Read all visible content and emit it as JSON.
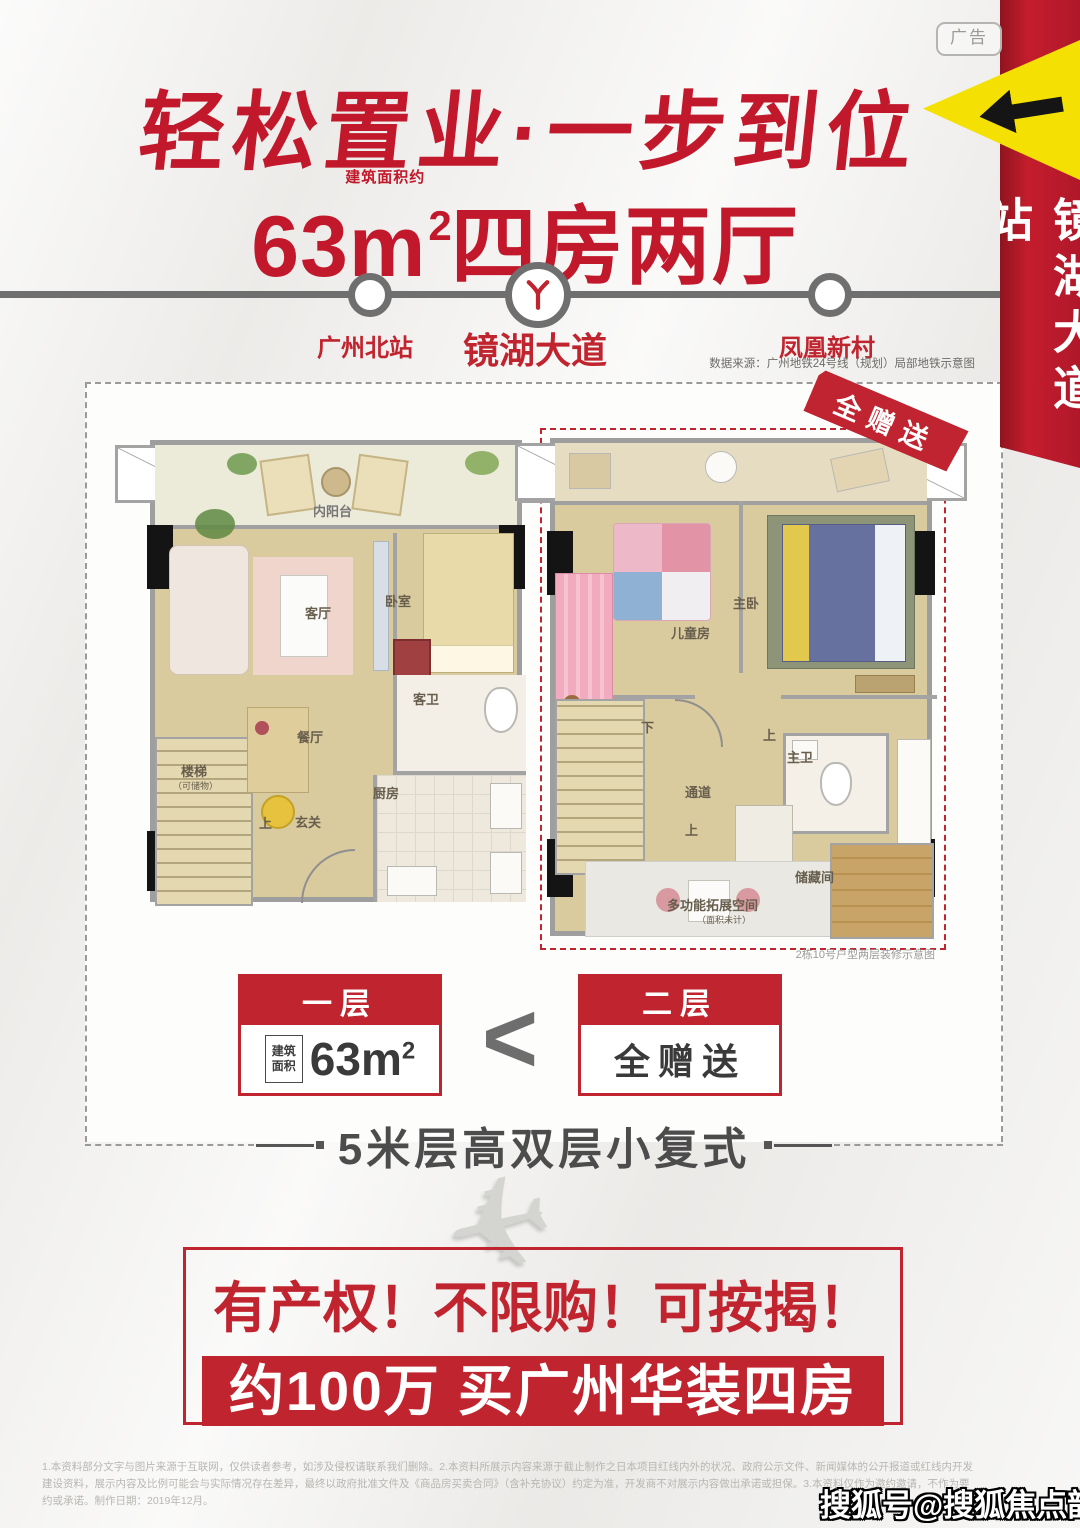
{
  "ad_badge": "广告",
  "side_banner": {
    "station": "镜湖大道站"
  },
  "title": "轻松置业·一步到位",
  "subtitle": {
    "area_note": "建筑面积约",
    "area": "63m",
    "area_sup": "2",
    "suffix": "四房两厅"
  },
  "metro": {
    "stations": [
      {
        "name": "广州北站"
      },
      {
        "name": "镜湖大道"
      },
      {
        "name": "凤凰新村"
      }
    ],
    "source": "数据来源：广州地铁24号线（规划）局部地铁示意图"
  },
  "plans": {
    "first": {
      "balcony": "内阳台",
      "rooms": [
        "客厅",
        "卧室",
        "客卫",
        "餐厅",
        "厨房",
        "玄关",
        "楼梯",
        "（可储物）"
      ],
      "up": "上"
    },
    "second": {
      "ribbon": "全赠送",
      "rooms": [
        "儿童房",
        "主卧",
        "主卫",
        "通道",
        "储藏间",
        "多功能拓展空间",
        "（面积未计）"
      ],
      "down": "下",
      "up": "上",
      "up2": "上",
      "caption": "2栋10号户型两层装修示意图"
    },
    "cards": {
      "first_title": "一层",
      "area_label_1": "建筑",
      "area_label_2": "面积",
      "area_value": "63m",
      "area_sup": "2",
      "compare": "<",
      "second_title": "二层",
      "second_value": "全赠送"
    },
    "tagline": "5米层高双层小复式"
  },
  "promo": {
    "line1": "有产权！不限购！可按揭！",
    "line2": "约100万 买广州华装四房"
  },
  "plane_icon": "✈",
  "disclaimer": "1.本资料部分文字与图片来源于互联网，仅供读者参考，如涉及侵权请联系我们删除。2.本资料所展示内容来源于截止制作之日本项目红线内外的状况、政府公示文件、新闻媒体的公开报道或红线内开发建设资料，展示内容及比例可能会与实际情况存在差异，最终以政府批准文件及《商品房买卖合同》（含补充协议）约定为准，开发商不对展示内容做出承诺或担保。3.本资料仅作为邀约邀请，不作为要约或承诺。制作日期：2019年12月。",
  "watermark": "搜狐号@搜狐焦点韶关站",
  "colors": {
    "primary_red": "#c0242f",
    "banner_yellow": "#f4e103",
    "line_gray": "#6f6f6f"
  }
}
